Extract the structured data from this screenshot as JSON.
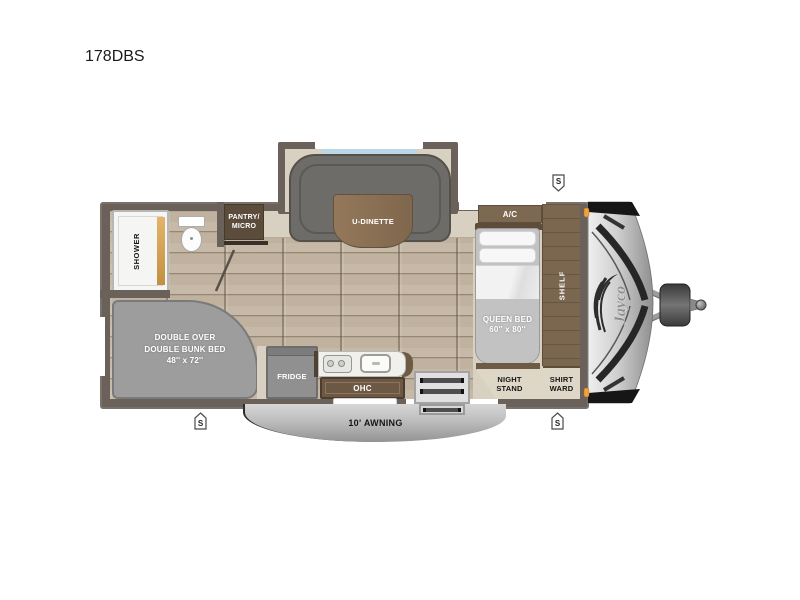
{
  "title": "178DBS",
  "brand_logo": "Jayco",
  "speaker_badge": "S",
  "rooms": {
    "shower": {
      "label": "SHOWER"
    },
    "pantry_micro": {
      "line1": "PANTRY/",
      "line2": "MICRO"
    },
    "u_dinette": {
      "label": "U-DINETTE"
    },
    "ac": {
      "label": "A/C"
    },
    "shelf": {
      "label": "SHELF"
    },
    "queen_bed": {
      "line1": "QUEEN BED",
      "line2": "60'' x 80''"
    },
    "night_stand": {
      "line1": "NIGHT",
      "line2": "STAND"
    },
    "shirt_wardrobe": {
      "line1": "SHIRT",
      "line2": "WARD"
    },
    "bunk_bed": {
      "line1": "DOUBLE OVER",
      "line2": "DOUBLE BUNK BED",
      "line3": "48'' x 72''"
    },
    "fridge": {
      "label": "FRIDGE"
    },
    "ohc": {
      "label": "OHC"
    },
    "awning": {
      "label": "10' AWNING"
    }
  },
  "colors": {
    "wall": "#6a615a",
    "floor": "#c0b29e",
    "cream": "#d8d1c2",
    "cabinet_brown": "#7b6750",
    "dark_brown": "#5c4c3c",
    "sofa_gray": "#6e6c69",
    "bunk_gray": "#9d9d9d",
    "bed_gray": "#c2c2c2",
    "window_blue": "#bcd7e5",
    "awning_gray": "#bdbdbd",
    "marker_orange": "#f1a13d",
    "cap_silver": "#d9d9d9"
  }
}
